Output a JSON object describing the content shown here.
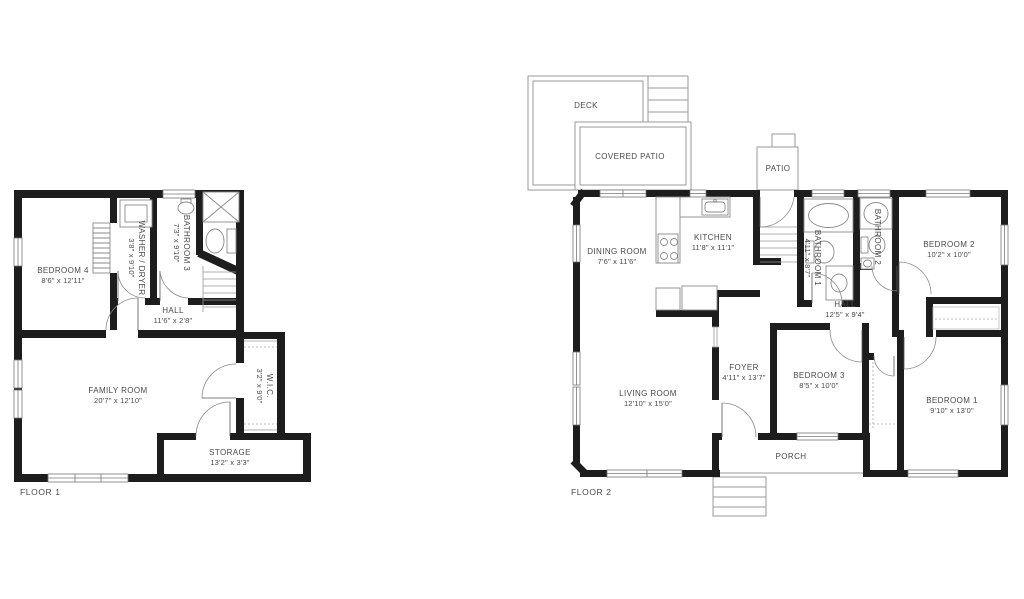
{
  "page": {
    "background": "#ffffff"
  },
  "colors": {
    "wall": "#1d1d1d",
    "line": "#8f8f8f",
    "text": "#4a4a4a"
  },
  "floor1": {
    "title": "FLOOR 1",
    "rooms": {
      "bedroom4": {
        "name": "BEDROOM 4",
        "dims": "8'6\" x 12'11\""
      },
      "washer_dryer": {
        "name": "WASHER / DRYER",
        "dims": "3'8\" x 9'10\""
      },
      "bathroom3": {
        "name": "BATHROOM 3",
        "dims": "7'3\" x 9'10\""
      },
      "hall": {
        "name": "HALL",
        "dims": "11'6\" x 2'8\""
      },
      "family_room": {
        "name": "FAMILY ROOM",
        "dims": "20'7\" x 12'10\""
      },
      "wic": {
        "name": "W.I.C.",
        "dims": "3'2\" x 9'0\""
      },
      "storage": {
        "name": "STORAGE",
        "dims": "13'2\" x 3'3\""
      }
    }
  },
  "floor2": {
    "title": "FLOOR 2",
    "rooms": {
      "deck": {
        "name": "DECK"
      },
      "covered_patio": {
        "name": "COVERED PATIO"
      },
      "patio": {
        "name": "PATIO"
      },
      "dining_room": {
        "name": "DINING ROOM",
        "dims": "7'6\" x 11'6\""
      },
      "kitchen": {
        "name": "KITCHEN",
        "dims": "11'8\" x 11'1\""
      },
      "bathroom1": {
        "name": "BATHROOM 1",
        "dims": "4'11\" x 8'7\""
      },
      "bathroom2": {
        "name": "BATHROOM 2"
      },
      "bedroom2": {
        "name": "BEDROOM 2",
        "dims": "10'2\" x 10'0\""
      },
      "hall": {
        "name": "HALL",
        "dims": "12'5\" x 9'4\""
      },
      "foyer": {
        "name": "FOYER",
        "dims": "4'11\" x 13'7\""
      },
      "living_room": {
        "name": "LIVING ROOM",
        "dims": "12'10\" x 15'0\""
      },
      "bedroom3": {
        "name": "BEDROOM 3",
        "dims": "8'5\" x 10'0\""
      },
      "bedroom1": {
        "name": "BEDROOM 1",
        "dims": "9'10\" x 13'0\""
      },
      "porch": {
        "name": "PORCH"
      }
    }
  }
}
